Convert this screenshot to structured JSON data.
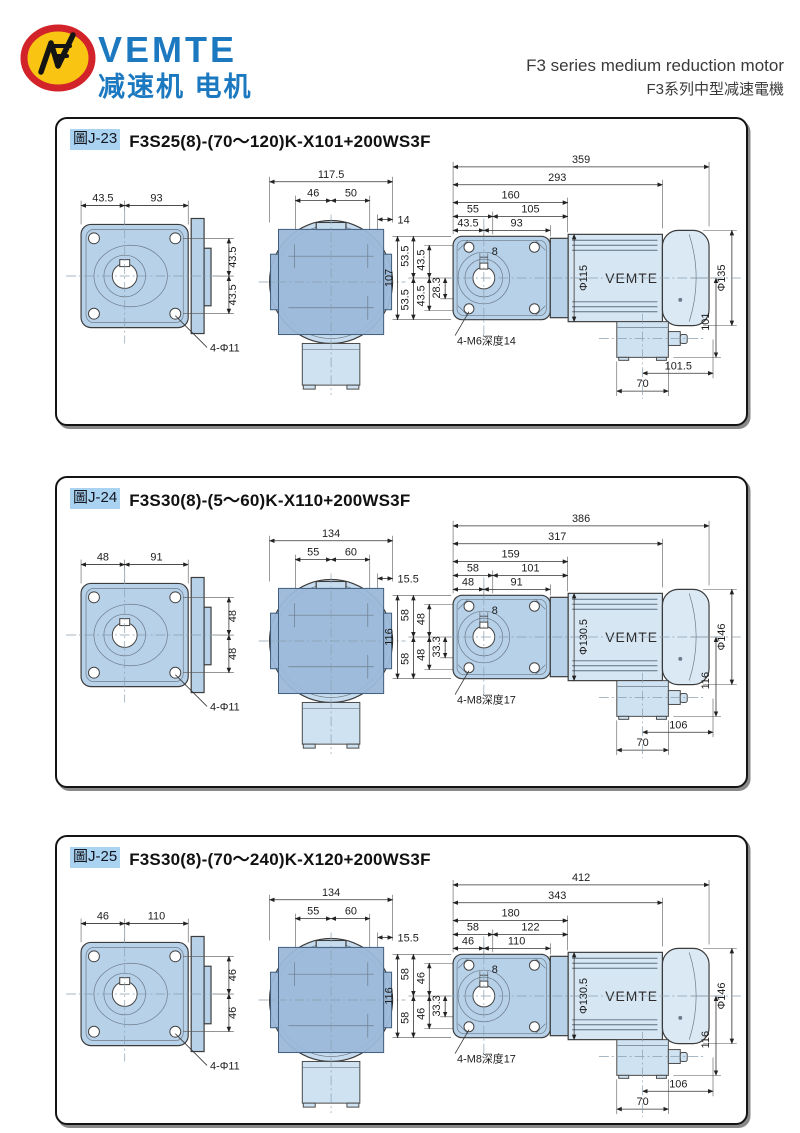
{
  "header": {
    "brand": "VEMTE",
    "brand_sub": "减速机 电机",
    "title_en": "F3 series medium reduction motor",
    "title_zh": "F3系列中型减速電機"
  },
  "panels": [
    {
      "badge": "圖J-23",
      "model": "F3S25(8)-(70～120)K-X101+200WS3F",
      "front": {
        "a": "43.5",
        "b": "93",
        "r1": "43.5",
        "r2": "43.5",
        "hole": "4-Φ11"
      },
      "side": {
        "w": "117.5",
        "a": "46",
        "b": "50",
        "off": "14"
      },
      "main": {
        "overall": "359",
        "body": "293",
        "face": "160",
        "a1": "55",
        "a2": "105",
        "b1": "43.5",
        "b2": "93",
        "key": "8",
        "s_out": "107",
        "s_m1": "53.5",
        "s_m2": "53.5",
        "s_i1": "43.5",
        "s_i2": "43.5",
        "s_c": "28.3",
        "motor_dia": "Φ115",
        "brand": "VEMTE",
        "cap_dia": "Φ135",
        "tap": "4-M6深度14",
        "v_right": "101",
        "box_span": "101.5",
        "box_w": "70"
      }
    },
    {
      "badge": "圖J-24",
      "model": "F3S30(8)-(5～60)K-X110+200WS3F",
      "front": {
        "a": "48",
        "b": "91",
        "r1": "48",
        "r2": "48",
        "hole": "4-Φ11"
      },
      "side": {
        "w": "134",
        "a": "55",
        "b": "60",
        "off": "15.5"
      },
      "main": {
        "overall": "386",
        "body": "317",
        "face": "159",
        "a1": "58",
        "a2": "101",
        "b1": "48",
        "b2": "91",
        "key": "8",
        "s_out": "116",
        "s_m1": "58",
        "s_m2": "58",
        "s_i1": "48",
        "s_i2": "48",
        "s_c": "33.3",
        "motor_dia": "Φ130.5",
        "brand": "VEMTE",
        "cap_dia": "Φ146",
        "tap": "4-M8深度17",
        "v_right": "116",
        "box_span": "106",
        "box_w": "70"
      }
    },
    {
      "badge": "圖J-25",
      "model": "F3S30(8)-(70～240)K-X120+200WS3F",
      "front": {
        "a": "46",
        "b": "110",
        "r1": "46",
        "r2": "46",
        "hole": "4-Φ11"
      },
      "side": {
        "w": "134",
        "a": "55",
        "b": "60",
        "off": "15.5"
      },
      "main": {
        "overall": "412",
        "body": "343",
        "face": "180",
        "a1": "58",
        "a2": "122",
        "b1": "46",
        "b2": "110",
        "key": "8",
        "s_out": "116",
        "s_m1": "58",
        "s_m2": "58",
        "s_i1": "46",
        "s_i2": "46",
        "s_c": "33.3",
        "motor_dia": "Φ130.5",
        "brand": "VEMTE",
        "cap_dia": "Φ146",
        "tap": "4-M8深度17",
        "v_right": "116",
        "box_span": "106",
        "box_w": "70"
      }
    }
  ]
}
